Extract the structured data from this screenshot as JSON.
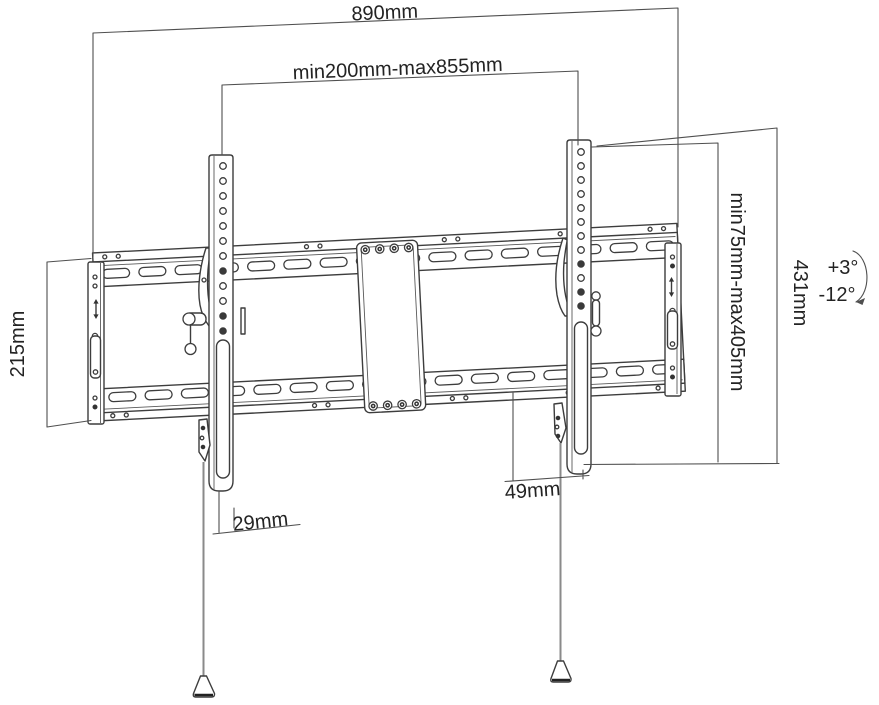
{
  "diagram": {
    "type": "technical-dimension-drawing",
    "subject": "Tilting TV wall mount bracket",
    "background_color": "#ffffff",
    "line_color": "#3d3d3d",
    "dimension_line_color": "#4f4f4f",
    "text_color": "#232323",
    "string_color": "#8a8a8a"
  },
  "dimensions": {
    "overall_width": "890mm",
    "vesa_width_range": "min200mm-max855mm",
    "wall_plate_height": "215mm",
    "vesa_height_range": "min75mm-max405mm",
    "bracket_height": "431mm",
    "bottom_offset_left": "29mm",
    "bottom_offset_right": "49mm"
  },
  "tilt": {
    "up": "+3°",
    "down": "-12°"
  }
}
